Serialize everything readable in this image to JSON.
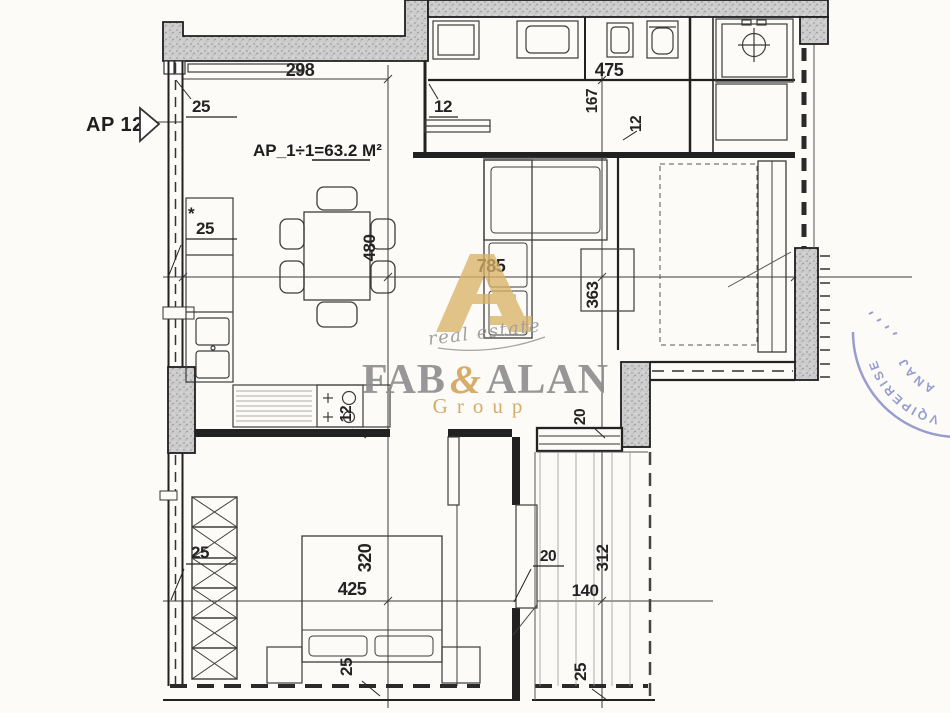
{
  "marker": {
    "label": "AP 12"
  },
  "area": {
    "prefix": "AP_1÷1=",
    "value": "63.2 M²"
  },
  "dims": {
    "d298": "298",
    "d25_top": "25",
    "d12_entry": "12",
    "d475": "475",
    "d167": "167",
    "d12_hall": "12",
    "star": "*",
    "d25_window": "25",
    "d480": "480",
    "d785": "785",
    "d363": "363",
    "d12_kitchen": "12",
    "d20_hall": "20",
    "d20_balcony": "20",
    "d140": "140",
    "d312": "312",
    "d25_balcony": "25",
    "d425": "425",
    "d320": "320",
    "d25_wardrobe": "25",
    "d25_bed": "25"
  },
  "watermark": {
    "script": "real estate",
    "name_a": "FAB",
    "amp": "&",
    "name_b": "ALAN",
    "group": "Group",
    "gold": "#d6ab5e",
    "gray": "#8d8d8d"
  },
  "stamp": {
    "arc_text": "VQIPERISE",
    "arc_text2": "ANAJ",
    "color": "#7d82c4"
  }
}
